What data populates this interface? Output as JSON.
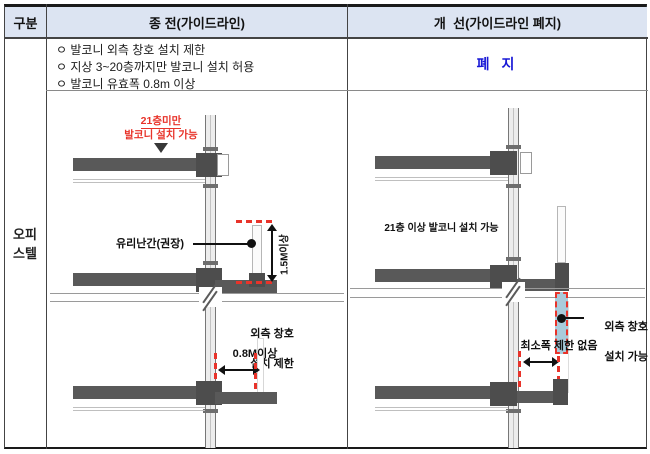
{
  "colors": {
    "header_bg": "#dce4f2",
    "table_border": "#1a1a1a",
    "abolish_blue": "#1717d6",
    "annotation_red": "#e8332a",
    "slab_gray": "#595959",
    "window_blue": "#a9cbdb"
  },
  "header": {
    "col_category": "구분",
    "col_before": "종 전(가이드라인)",
    "col_after": "개  선(가이드라인 폐지)"
  },
  "row": {
    "category_line1": "오피",
    "category_line2": "스텔",
    "before_bullets": [
      "ㅇ 발코니 외측 창호 설치 제한",
      "ㅇ 지상 3~20층까지만 발코니 설치 허용",
      "ㅇ 발코니 유효폭 0.8m 이상"
    ],
    "after_text": "폐 지"
  },
  "diagram_before": {
    "floor_limit_note_line1": "21층미만",
    "floor_limit_note_line2": "발코니 설치 가능",
    "railing_label": "유리난간(권장)",
    "height_dimension": "1.5M이상",
    "window_restriction_line1": "외측 창호",
    "window_restriction_line2": "설치 제한",
    "width_dimension": "0.8M이상"
  },
  "diagram_after": {
    "floor_allow_note": "21층 이상 발코니 설치 가능",
    "window_allow_line1": "외측 창호",
    "window_allow_line2": "설치 가능",
    "width_note": "최소폭 제한 없음"
  }
}
